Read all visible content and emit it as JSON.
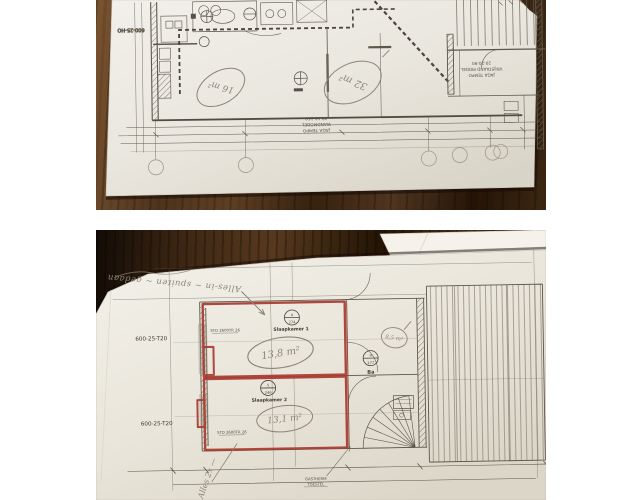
{
  "colors": {
    "red_marker": "#a93b30",
    "pencil": "#8c8476",
    "ink": "#4a443c",
    "paper": "#ece9e1",
    "wood_dark": "#241406",
    "wood_light": "#7a5430"
  },
  "photos": {
    "top": {
      "left_code": "600-25-HO",
      "heater_wall": {
        "l1": "JAGA TEMPO",
        "l2": "WANDMODEL",
        "l3": "30-10-160"
      },
      "heater_free": {
        "l1": "JAGA TEMPO",
        "l2": "VRIJSTAAND MODEL",
        "l3": "20-20-90"
      },
      "area_note_left": "16 m²",
      "area_note_right": "32 m²"
    },
    "bottom": {
      "left_code_1": "600-25-T20",
      "left_code_2": "600-25-T20",
      "room1": {
        "tag_top": "4",
        "tag_bottom": "274",
        "label": "Slaapkamer 1",
        "area_note": "13,8 m²"
      },
      "room2": {
        "tag_top": "5",
        "tag_bottom": "246",
        "label": "Slaapkamer 2",
        "area_note": "13,1 m²"
      },
      "bath": {
        "tag_top": "9",
        "tag_bottom": "177",
        "label": "Ba",
        "area_note": "8,5 m²"
      },
      "wall_label_1": "STD 2600TR 26",
      "wall_label_2": "STD 2600TR 26",
      "boiler_label_1": "GASTHERM",
      "boiler_label_2": "TOESTEL",
      "note_top": "Alles-in ~ spuiten ~ gedaan",
      "note_bottom": "Alles 2x —"
    }
  }
}
